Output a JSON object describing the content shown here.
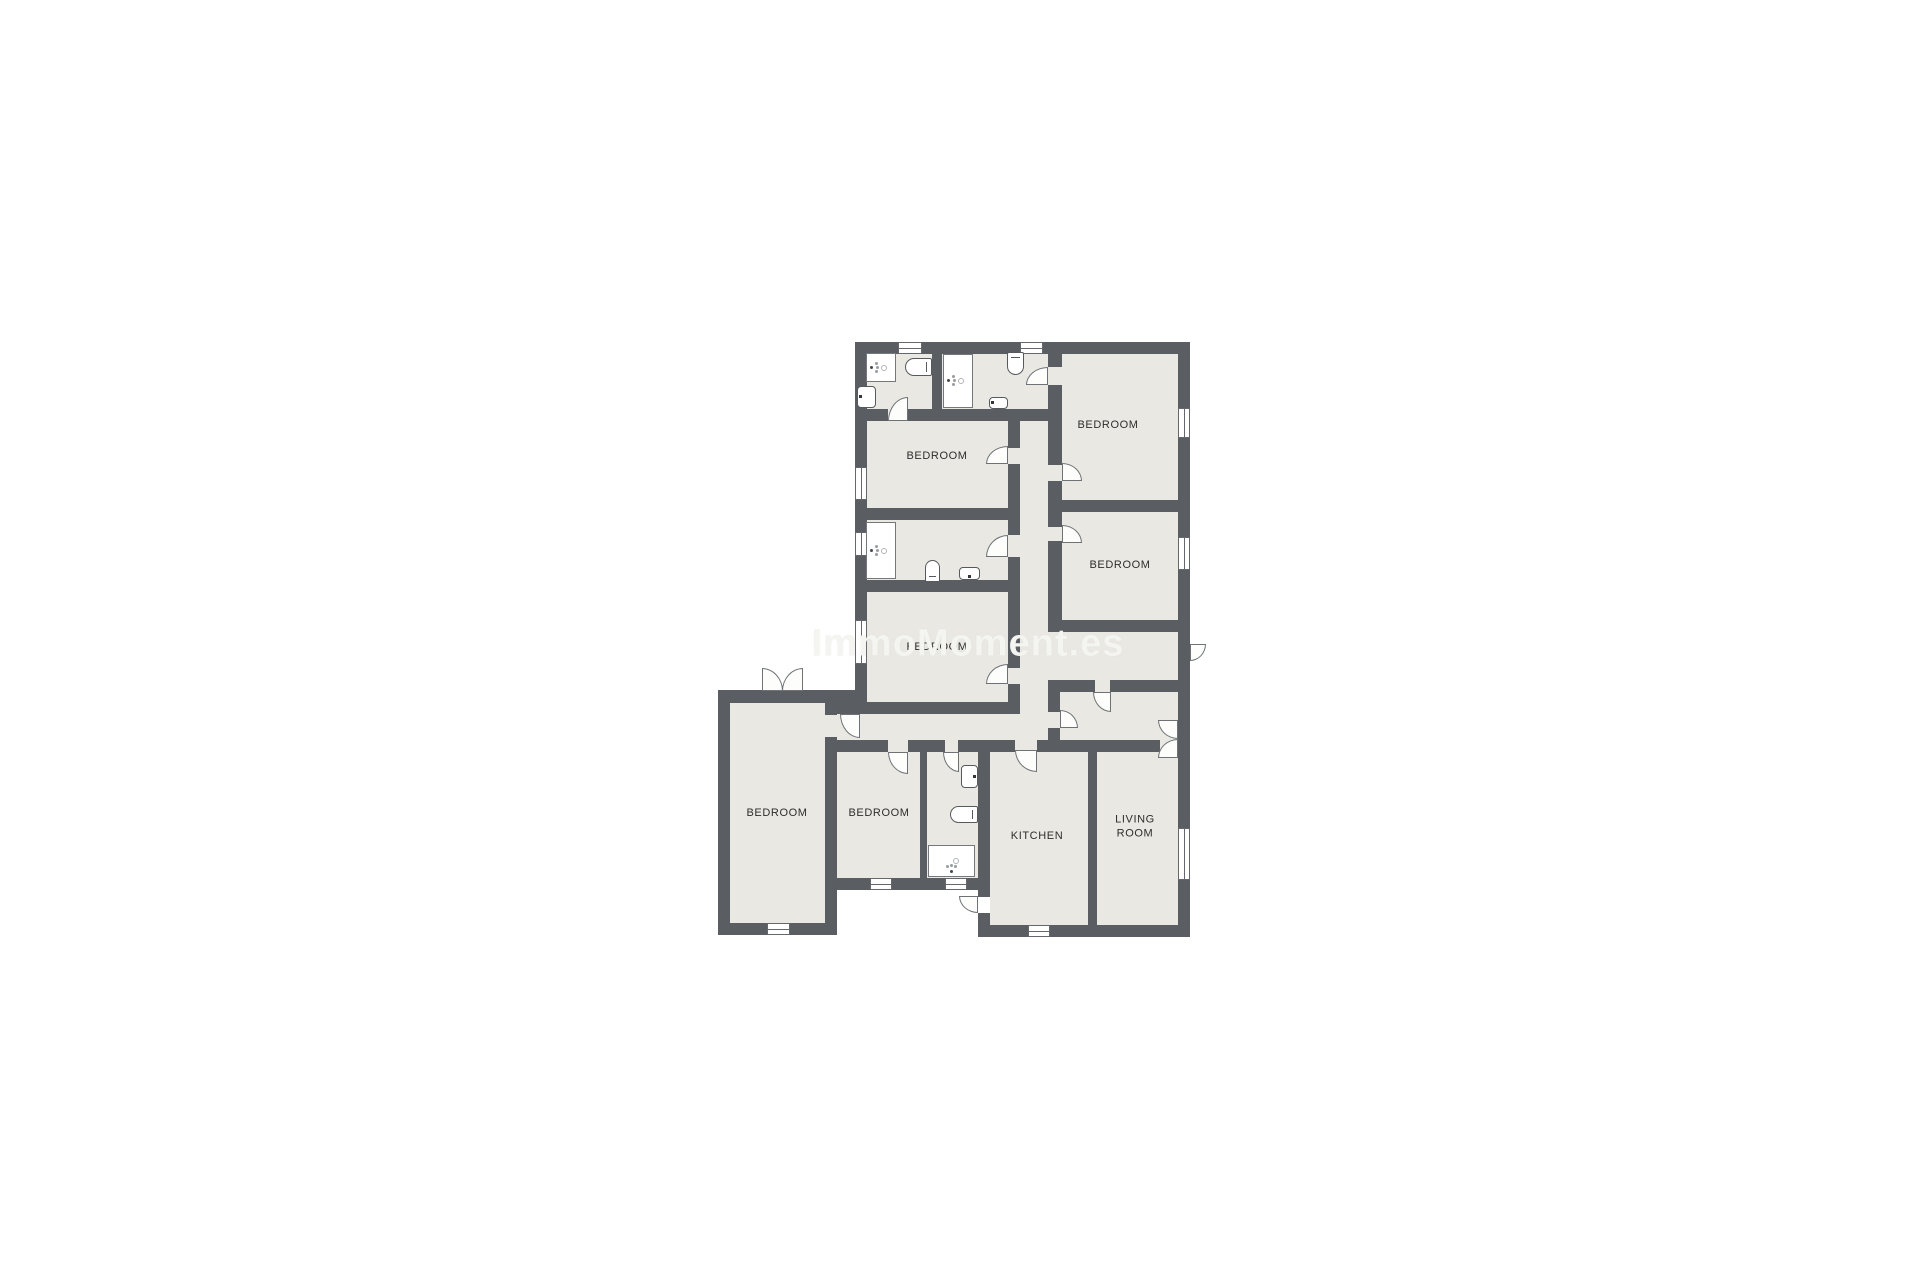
{
  "watermark": {
    "text": "ImmoMoment.es"
  },
  "colors": {
    "background": "#ffffff",
    "wall": "#5a5e63",
    "room_fill": "#e9e8e2",
    "fixture_outline": "#565a5e",
    "label_text": "#2d2d2d",
    "watermark_text": "#f4f4f0"
  },
  "labels": [
    {
      "text": "BEDROOM",
      "x": 1108,
      "y": 425
    },
    {
      "text": "BEDROOM",
      "x": 937,
      "y": 456
    },
    {
      "text": "BEDROOM",
      "x": 1120,
      "y": 565
    },
    {
      "text": "BEDROOM",
      "x": 937,
      "y": 647
    },
    {
      "text": "BEDROOM",
      "x": 777,
      "y": 813
    },
    {
      "text": "BEDROOM",
      "x": 879,
      "y": 813
    },
    {
      "text": "KITCHEN",
      "x": 1037,
      "y": 836
    },
    {
      "text": "LIVING\nROOM",
      "x": 1135,
      "y": 827
    }
  ],
  "rooms": [
    {
      "id": "bathroom-top-left",
      "rect": [
        867,
        353,
        65,
        58
      ]
    },
    {
      "id": "bathroom-top-mid",
      "rect": [
        942,
        354,
        106,
        55
      ]
    },
    {
      "id": "bedroom-top-right",
      "rect": [
        1062,
        353,
        116,
        147
      ]
    },
    {
      "id": "bedroom-mid-left",
      "rect": [
        867,
        421,
        141,
        87
      ]
    },
    {
      "id": "corridor-vertical",
      "rect": [
        1020,
        421,
        28,
        319
      ]
    },
    {
      "id": "bathroom-middle",
      "rect": [
        867,
        520,
        141,
        60
      ]
    },
    {
      "id": "bedroom-mid-lower",
      "rect": [
        867,
        592,
        141,
        110
      ]
    },
    {
      "id": "bedroom-right-2",
      "rect": [
        1062,
        512,
        116,
        108
      ]
    },
    {
      "id": "corridor-east",
      "rect": [
        1048,
        632,
        130,
        48
      ]
    },
    {
      "id": "entry-hall",
      "rect": [
        1060,
        692,
        118,
        48
      ]
    },
    {
      "id": "hall-south",
      "rect": [
        837,
        714,
        183,
        26
      ]
    },
    {
      "id": "bedroom-west",
      "rect": [
        730,
        703,
        95,
        220
      ]
    },
    {
      "id": "bedroom-south",
      "rect": [
        837,
        752,
        83,
        126
      ]
    },
    {
      "id": "bathroom-south",
      "rect": [
        927,
        752,
        51,
        126
      ]
    },
    {
      "id": "kitchen",
      "rect": [
        990,
        750,
        98,
        175
      ]
    },
    {
      "id": "living-room",
      "rect": [
        1097,
        750,
        81,
        175
      ]
    }
  ],
  "walls": [
    [
      855,
      342,
      335,
      12
    ],
    [
      855,
      342,
      12,
      361
    ],
    [
      1178,
      342,
      12,
      595
    ],
    [
      718,
      690,
      149,
      13
    ],
    [
      718,
      690,
      12,
      245
    ],
    [
      718,
      923,
      119,
      12
    ],
    [
      978,
      925,
      212,
      12
    ],
    [
      825,
      878,
      165,
      12
    ],
    [
      932,
      353,
      10,
      56
    ],
    [
      1048,
      353,
      14,
      14
    ],
    [
      1048,
      385,
      14,
      80
    ],
    [
      1048,
      481,
      14,
      46
    ],
    [
      1048,
      541,
      14,
      79
    ],
    [
      1048,
      620,
      130,
      12
    ],
    [
      1058,
      680,
      37,
      12
    ],
    [
      1110,
      680,
      68,
      12
    ],
    [
      1048,
      680,
      12,
      32
    ],
    [
      1048,
      728,
      12,
      12
    ],
    [
      1008,
      421,
      12,
      27
    ],
    [
      1008,
      464,
      12,
      71
    ],
    [
      1008,
      557,
      12,
      111
    ],
    [
      1008,
      684,
      12,
      28
    ],
    [
      855,
      409,
      33,
      12
    ],
    [
      908,
      409,
      154,
      12
    ],
    [
      855,
      508,
      165,
      12
    ],
    [
      855,
      580,
      165,
      12
    ],
    [
      837,
      702,
      183,
      12
    ],
    [
      837,
      740,
      51,
      12
    ],
    [
      908,
      740,
      37,
      12
    ],
    [
      958,
      740,
      32,
      12
    ],
    [
      990,
      740,
      25,
      12
    ],
    [
      1037,
      740,
      60,
      12
    ],
    [
      1097,
      740,
      63,
      12
    ],
    [
      1088,
      750,
      9,
      175
    ],
    [
      825,
      703,
      12,
      12
    ],
    [
      825,
      737,
      12,
      186
    ],
    [
      920,
      752,
      7,
      126
    ],
    [
      978,
      740,
      12,
      157
    ],
    [
      978,
      913,
      12,
      24
    ],
    [
      1062,
      500,
      116,
      12
    ]
  ],
  "gaps": [
    [
      888,
      409,
      20,
      12
    ],
    [
      1048,
      367,
      14,
      18
    ],
    [
      1008,
      448,
      12,
      16
    ],
    [
      1048,
      465,
      14,
      16
    ],
    [
      1048,
      527,
      14,
      14
    ],
    [
      1008,
      535,
      12,
      22
    ],
    [
      1008,
      668,
      12,
      16
    ],
    [
      825,
      715,
      12,
      22
    ],
    [
      888,
      740,
      20,
      12
    ],
    [
      943,
      740,
      15,
      12
    ],
    [
      1015,
      740,
      22,
      10
    ],
    [
      1095,
      680,
      15,
      12
    ],
    [
      1048,
      712,
      12,
      16
    ],
    [
      1160,
      740,
      18,
      10
    ]
  ],
  "windows": [
    {
      "rect": [
        898,
        342,
        24,
        12
      ],
      "orient": "h"
    },
    {
      "rect": [
        1020,
        342,
        23,
        12
      ],
      "orient": "h"
    },
    {
      "rect": [
        855,
        467,
        12,
        33
      ],
      "orient": "v"
    },
    {
      "rect": [
        855,
        532,
        12,
        24
      ],
      "orient": "v"
    },
    {
      "rect": [
        855,
        620,
        12,
        44
      ],
      "orient": "v"
    },
    {
      "rect": [
        1178,
        408,
        12,
        30
      ],
      "orient": "v"
    },
    {
      "rect": [
        1178,
        537,
        12,
        33
      ],
      "orient": "v"
    },
    {
      "rect": [
        1178,
        828,
        12,
        52
      ],
      "orient": "v"
    },
    {
      "rect": [
        767,
        923,
        23,
        12
      ],
      "orient": "h"
    },
    {
      "rect": [
        870,
        878,
        22,
        12
      ],
      "orient": "h"
    },
    {
      "rect": [
        945,
        878,
        22,
        12
      ],
      "orient": "h"
    },
    {
      "rect": [
        1028,
        925,
        22,
        12
      ],
      "orient": "h"
    }
  ],
  "doors": [
    {
      "id": "bathroom-top-left-door",
      "rect": [
        888,
        397,
        20,
        24
      ],
      "round": "tl"
    },
    {
      "id": "bathroom-top-mid-door",
      "rect": [
        1026,
        367,
        22,
        18
      ],
      "round": "tl"
    },
    {
      "id": "bedroom-mid-left-door",
      "rect": [
        986,
        446,
        22,
        18
      ],
      "round": "tl"
    },
    {
      "id": "bedroom-top-right-door",
      "rect": [
        1062,
        463,
        20,
        18
      ],
      "round": "tr"
    },
    {
      "id": "bedroom-right-2-door",
      "rect": [
        1062,
        525,
        20,
        18
      ],
      "round": "tr"
    },
    {
      "id": "bathroom-middle-door",
      "rect": [
        986,
        535,
        22,
        22
      ],
      "round": "tl"
    },
    {
      "id": "bedroom-mid-lower-door",
      "rect": [
        986,
        664,
        22,
        20
      ],
      "round": "tl"
    },
    {
      "id": "bedroom-west-door",
      "rect": [
        840,
        714,
        20,
        24
      ],
      "round": "bl"
    },
    {
      "id": "bedroom-south-door",
      "rect": [
        888,
        752,
        20,
        22
      ],
      "round": "bl"
    },
    {
      "id": "bathroom-south-door",
      "rect": [
        943,
        752,
        16,
        20
      ],
      "round": "bl"
    },
    {
      "id": "kitchen-door",
      "rect": [
        1015,
        750,
        22,
        22
      ],
      "round": "bl"
    },
    {
      "id": "entry-hall-door",
      "rect": [
        1093,
        692,
        18,
        20
      ],
      "round": "bl"
    },
    {
      "id": "corridor-entry-door",
      "rect": [
        1060,
        710,
        18,
        18
      ],
      "round": "tr"
    },
    {
      "id": "exterior-east-door",
      "rect": [
        1190,
        644,
        16,
        17
      ],
      "round": "br"
    },
    {
      "id": "kitchen-exterior-door",
      "rect": [
        959,
        896,
        19,
        17
      ],
      "round": "bl"
    },
    {
      "id": "french-door-west-left",
      "rect": [
        762,
        668,
        21,
        23
      ],
      "round": "tr"
    },
    {
      "id": "french-door-west-right",
      "rect": [
        782,
        668,
        21,
        23
      ],
      "round": "tl"
    },
    {
      "id": "french-door-east-top",
      "rect": [
        1158,
        720,
        20,
        19
      ],
      "round": "bl"
    },
    {
      "id": "french-door-east-bottom",
      "rect": [
        1158,
        739,
        20,
        19
      ],
      "round": "tl"
    }
  ],
  "fixtures": {
    "showers": [
      {
        "rect": [
          866,
          353,
          30,
          29
        ],
        "head": "left"
      },
      {
        "rect": [
          943,
          354,
          30,
          54
        ],
        "head": "left"
      },
      {
        "rect": [
          866,
          522,
          30,
          57
        ],
        "head": "left"
      },
      {
        "rect": [
          928,
          845,
          47,
          32
        ],
        "head": "bottom"
      }
    ],
    "toilets": [
      {
        "rect": [
          905,
          358,
          27,
          18
        ],
        "dir": "right"
      },
      {
        "rect": [
          1007,
          352,
          17,
          23
        ],
        "dir": "top"
      },
      {
        "rect": [
          925,
          560,
          15,
          22
        ],
        "dir": "bottom"
      },
      {
        "rect": [
          950,
          806,
          28,
          17
        ],
        "dir": "right"
      }
    ],
    "sinks": [
      {
        "rect": [
          857,
          386,
          19,
          22
        ],
        "tap": "left"
      },
      {
        "rect": [
          989,
          397,
          19,
          12
        ],
        "tap": "left"
      },
      {
        "rect": [
          959,
          567,
          21,
          13
        ],
        "tap": "bottom"
      },
      {
        "rect": [
          961,
          765,
          17,
          23
        ],
        "tap": "right"
      }
    ]
  }
}
